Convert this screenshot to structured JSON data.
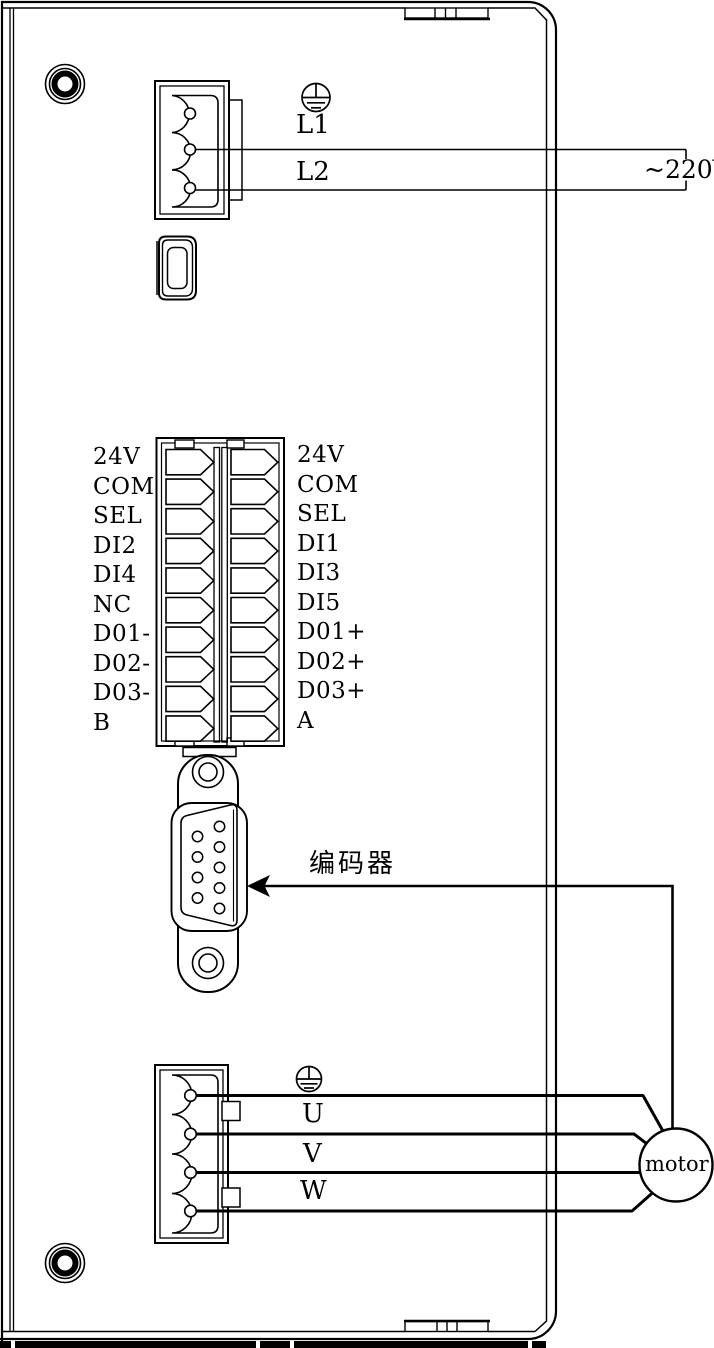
{
  "power_input": {
    "terminal_labels": [
      "L1",
      "L2"
    ],
    "supply_label": "~220V"
  },
  "io_terminal_block": {
    "left_labels": [
      "24V",
      "COM",
      "SEL",
      "DI2",
      "DI4",
      "NC",
      "D01-",
      "D02-",
      "D03-",
      "B"
    ],
    "right_labels": [
      "24V",
      "COM",
      "SEL",
      "DI1",
      "DI3",
      "DI5",
      "D01+",
      "D02+",
      "D03+",
      "A"
    ]
  },
  "encoder": {
    "label": "编码器"
  },
  "motor_output": {
    "phase_labels": [
      "U",
      "V",
      "W"
    ],
    "motor_label": "motor"
  },
  "icons": {
    "ground_top": "protective-earth-icon",
    "ground_bottom": "protective-earth-icon",
    "usb": "mini-usb-port-icon",
    "encoder_arrow": "arrow-left-icon"
  },
  "colors": {
    "line": "#000000",
    "background": "#ffffff"
  }
}
